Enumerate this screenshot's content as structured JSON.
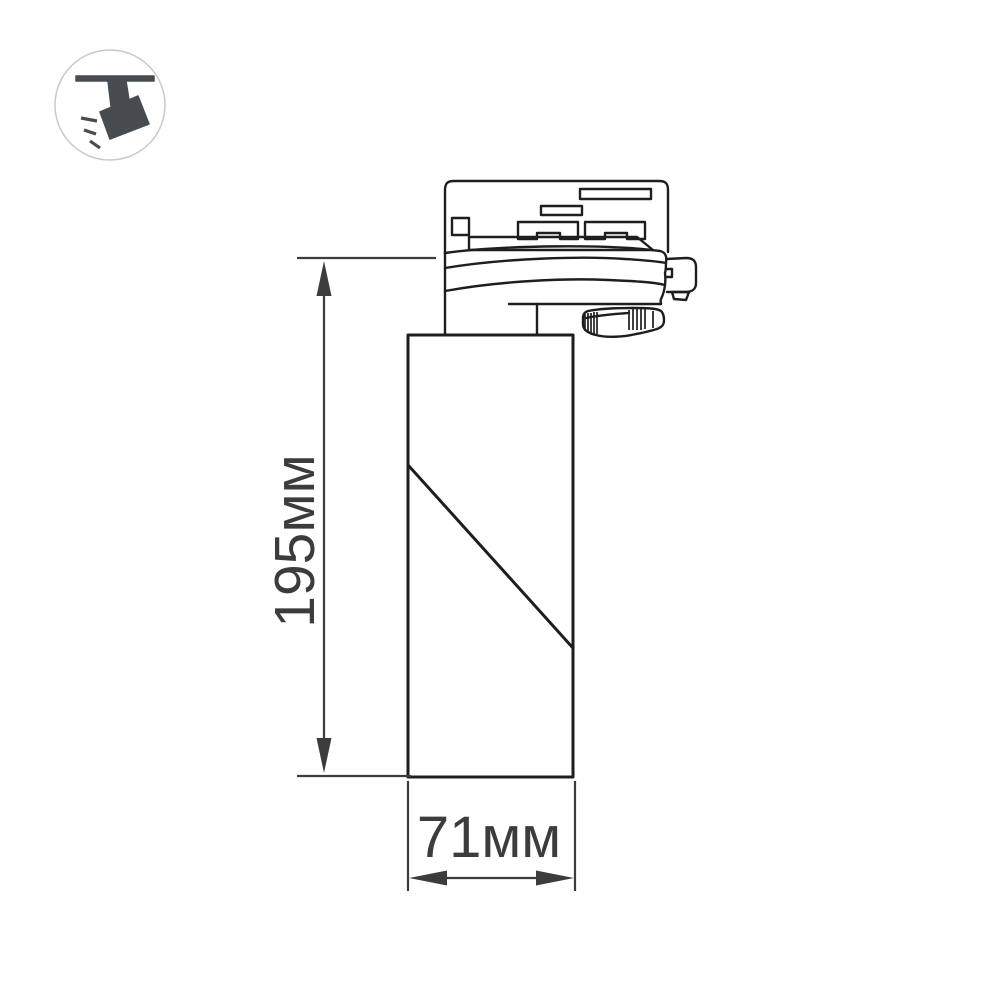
{
  "badge": {
    "icon_name": "track-spotlight-icon"
  },
  "dimensions": {
    "height": {
      "label": "195мм",
      "orientation": "vertical"
    },
    "width": {
      "label": "71мм",
      "orientation": "horizontal"
    }
  },
  "colors": {
    "background": "#ffffff",
    "line": "#1e1e1e",
    "dimension": "#3c3c3c",
    "icon": "#474c50",
    "circle": "#c9c9c9"
  }
}
